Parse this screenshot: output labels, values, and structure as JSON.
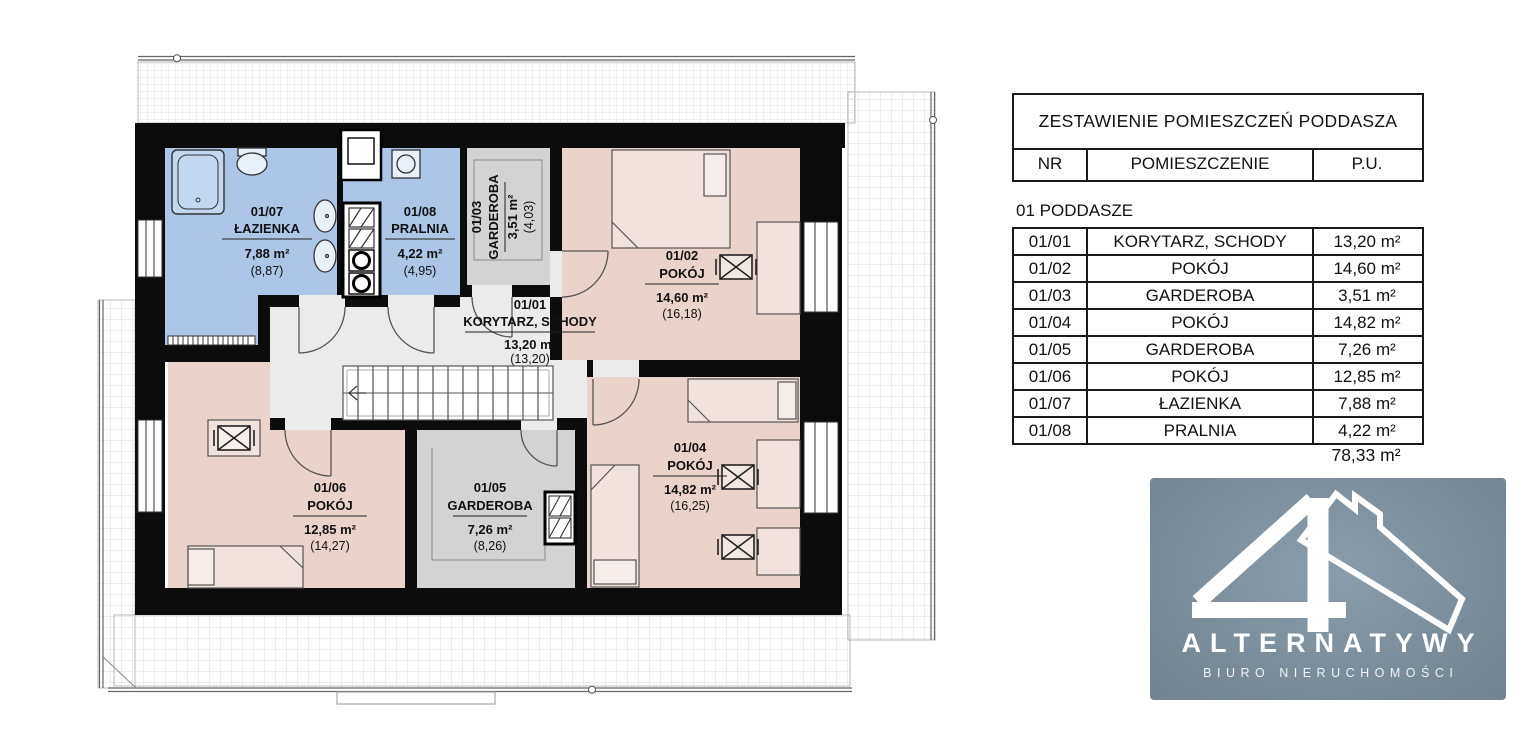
{
  "plan": {
    "rooms": [
      {
        "id": "01/07",
        "name": "ŁAZIENKA",
        "area": "7,88 m²",
        "gross": "(8,87)"
      },
      {
        "id": "01/08",
        "name": "PRALNIA",
        "area": "4,22 m²",
        "gross": "(4,95)"
      },
      {
        "id": "01/03",
        "name": "GARDEROBA",
        "area": "3,51 m²",
        "gross": "(4,03)"
      },
      {
        "id": "01/01",
        "name": "KORYTARZ, SCHODY",
        "area": "13,20 m²",
        "gross": "(13,20)"
      },
      {
        "id": "01/02",
        "name": "POKÓJ",
        "area": "14,60 m²",
        "gross": "(16,18)"
      },
      {
        "id": "01/06",
        "name": "POKÓJ",
        "area": "12,85 m²",
        "gross": "(14,27)"
      },
      {
        "id": "01/05",
        "name": "GARDEROBA",
        "area": "7,26 m²",
        "gross": "(8,26)"
      },
      {
        "id": "01/04",
        "name": "POKÓJ",
        "area": "14,82 m²",
        "gross": "(16,25)"
      }
    ],
    "colors": {
      "wall": "#0c0c0c",
      "wet": "#adc6e7",
      "room": "#ead3cb",
      "storage": "#d3d3d3",
      "hall": "#ebebeb"
    }
  },
  "schedule": {
    "title": "ZESTAWIENIE POMIESZCZEŃ PODDASZA",
    "columns": [
      "NR",
      "POMIESZCZENIE",
      "P.U."
    ],
    "section": "01 PODDASZE",
    "rows": [
      {
        "nr": "01/01",
        "room": "KORYTARZ, SCHODY",
        "area": "13,20 m²"
      },
      {
        "nr": "01/02",
        "room": "POKÓJ",
        "area": "14,60 m²"
      },
      {
        "nr": "01/03",
        "room": "GARDEROBA",
        "area": "3,51 m²"
      },
      {
        "nr": "01/04",
        "room": "POKÓJ",
        "area": "14,82 m²"
      },
      {
        "nr": "01/05",
        "room": "GARDEROBA",
        "area": "7,26 m²"
      },
      {
        "nr": "01/06",
        "room": "POKÓJ",
        "area": "12,85 m²"
      },
      {
        "nr": "01/07",
        "room": "ŁAZIENKA",
        "area": "7,88 m²"
      },
      {
        "nr": "01/08",
        "room": "PRALNIA",
        "area": "4,22 m²"
      }
    ],
    "total": "78,33 m²"
  },
  "logo": {
    "brand": "ALTERNATYWY",
    "subtitle": "BIURO NIERUCHOMOŚCI",
    "background": "#7b8e9a"
  }
}
